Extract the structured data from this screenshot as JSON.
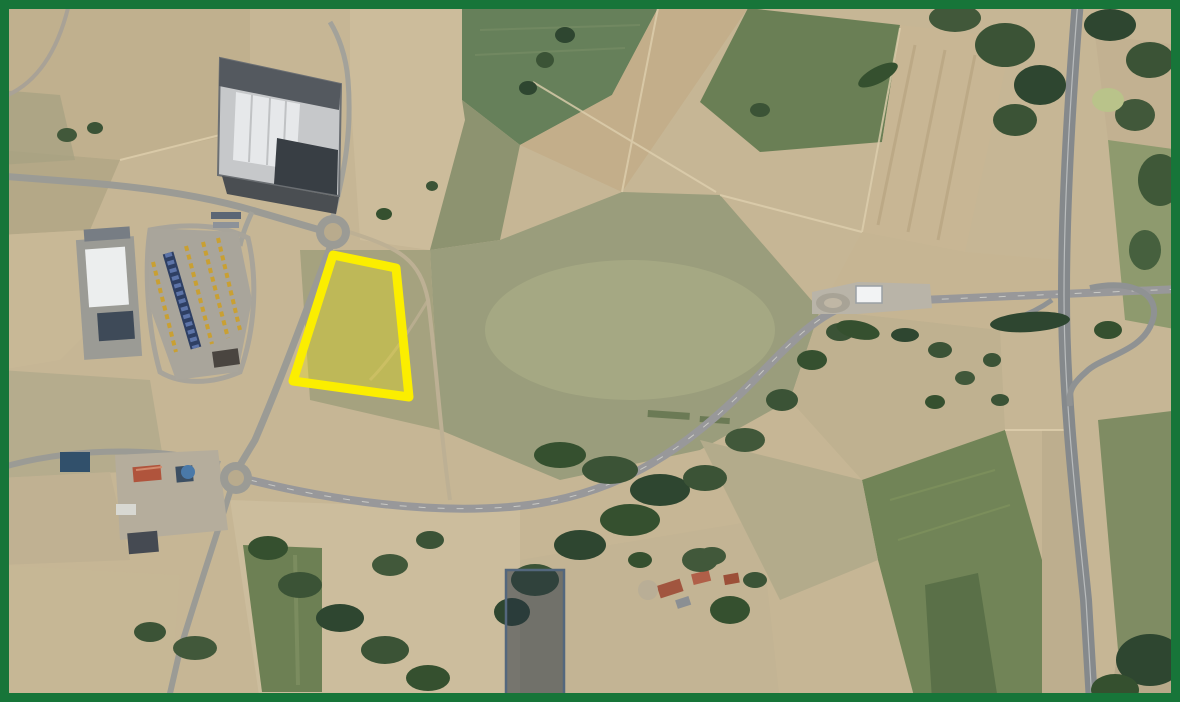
{
  "map": {
    "kind": "aerial-satellite-view",
    "colors": {
      "frame_green": "#177539",
      "highlight_yellow": "#fbee00",
      "overlay_slate_stroke": "#53677d",
      "base_tan": "#c6b695"
    }
  },
  "annotations": {
    "parcel_highlight": {
      "shape": "polygon",
      "points": "333,255 396,268 409,397 293,381",
      "stroke": "#fbee00",
      "stroke_width": "9",
      "fill": "rgba(250,235,0,0.30)"
    },
    "selection_rectangle": {
      "shape": "rect",
      "x": "506",
      "y": "570",
      "width": "58",
      "height": "127",
      "stroke": "#53677d",
      "stroke_width": "2.5",
      "fill": "rgba(38,52,68,0.52)"
    },
    "frame": {
      "color": "#177539",
      "stroke_width": "18"
    }
  }
}
